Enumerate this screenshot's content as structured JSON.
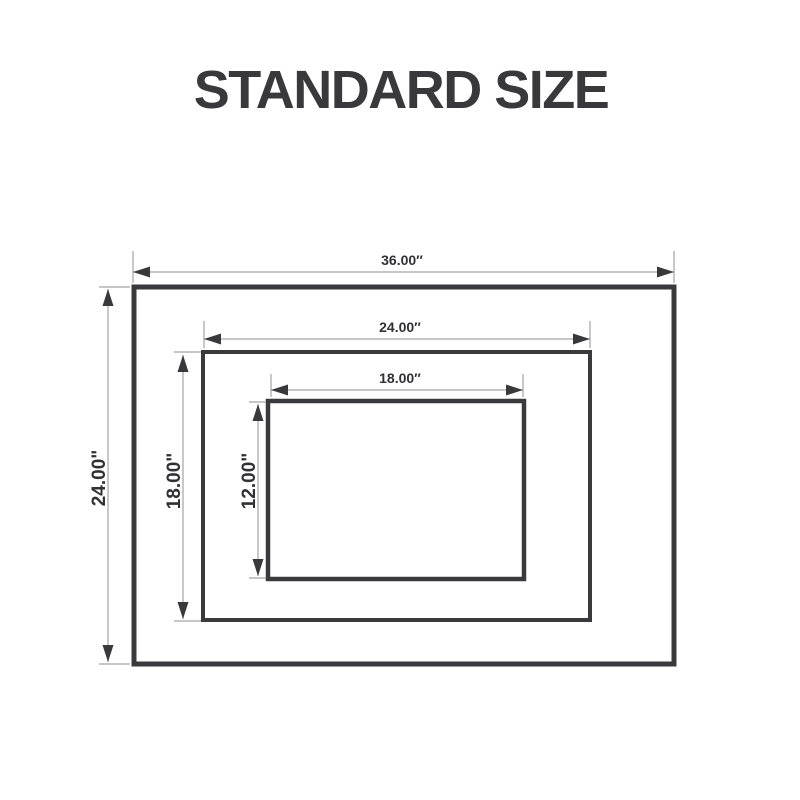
{
  "title": "STANDARD SIZE",
  "colors": {
    "background": "#ffffff",
    "rectangle_outline": "#3a3a3d",
    "dimension_line": "#a3a3a3",
    "arrowhead": "#39393b",
    "dimension_text": "#313134",
    "title_text": "#39393b"
  },
  "diagram": {
    "rectangles": [
      {
        "id": "outer",
        "width_label": "36.00″",
        "height_label": "24.00\""
      },
      {
        "id": "middle",
        "width_label": "24.00″",
        "height_label": "18.00\""
      },
      {
        "id": "inner",
        "width_label": "18.00″",
        "height_label": "12.00\""
      }
    ]
  }
}
